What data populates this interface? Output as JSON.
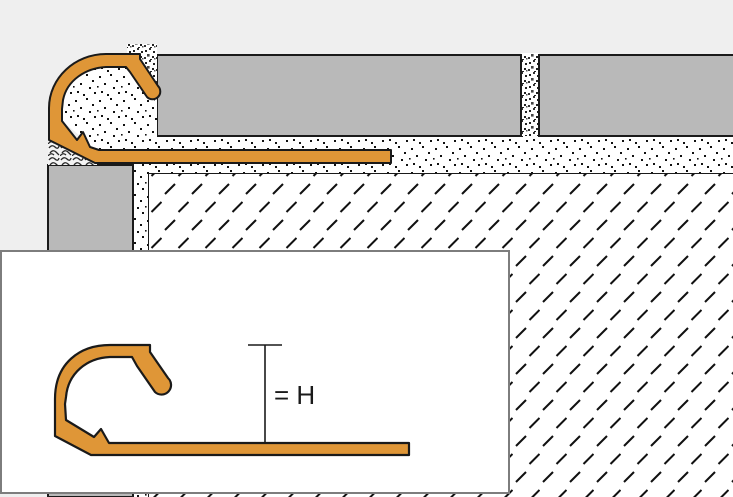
{
  "inset": {
    "dimension_label": "= H"
  },
  "colors": {
    "profile_orange": "#DF9637",
    "tile_gray": "#B9B9B9",
    "background_gray": "#EFEFEF",
    "outline_black": "#1A1A1A",
    "inset_border_gray": "#7D7D7D",
    "inset_background": "#FFFFFF",
    "substrate_white": "#FFFFFF"
  }
}
